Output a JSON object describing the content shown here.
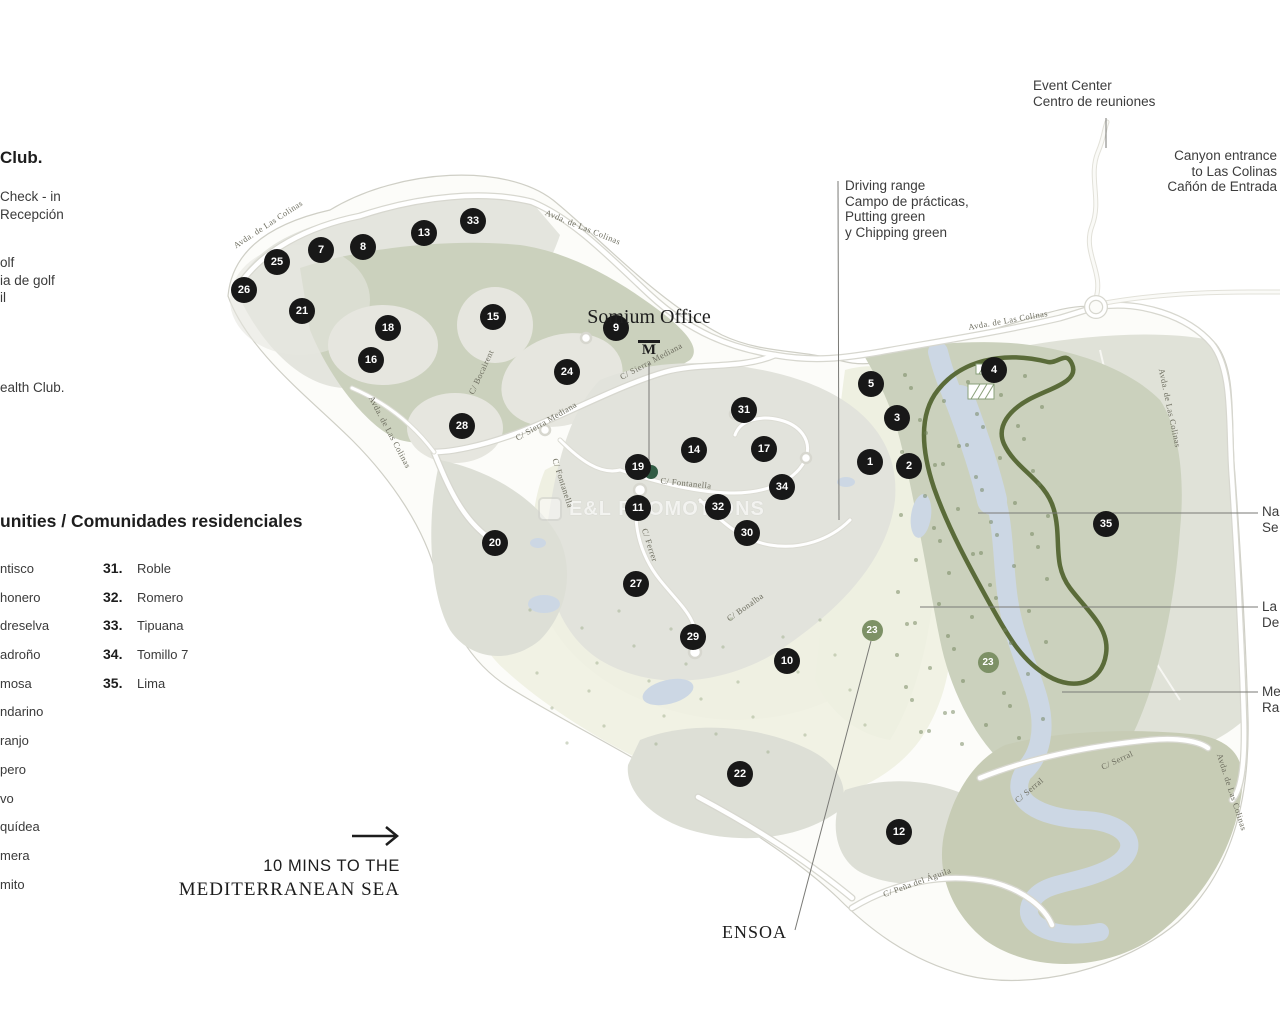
{
  "left_panel": {
    "club_fragment": "Club.",
    "checkin_lines": [
      "Check - in",
      "Recepción"
    ],
    "golf_fragments": [
      "olf",
      "ia de golf",
      "il"
    ],
    "health_fragment": "ealth Club.",
    "communities_heading": "unities / Comunidades residenciales",
    "communities_left": [
      "ntisco",
      "honero",
      "dreselva",
      "adroño",
      "mosa",
      "ndarino",
      "ranjo",
      "pero",
      "vo",
      "quídea",
      "mera",
      "mito"
    ],
    "communities_right": [
      {
        "num": "31.",
        "name": "Roble"
      },
      {
        "num": "32.",
        "name": "Romero"
      },
      {
        "num": "33.",
        "name": "Tipuana"
      },
      {
        "num": "34.",
        "name": "Tomillo 7"
      },
      {
        "num": "35.",
        "name": "Lima"
      }
    ],
    "sea_note_line1": "10 MINS TO THE",
    "sea_note_line2": "MEDITERRANEAN SEA"
  },
  "annotations": {
    "somium_label": "Somium Office",
    "somium_logo": "M",
    "driving_range_lines": [
      "Driving range",
      "Campo de prácticas,",
      "Putting green",
      "y Chipping green"
    ],
    "event_center_lines": [
      "Event Center",
      "Centro de reuniones"
    ],
    "canyon_entrance_lines": [
      "Canyon entrance",
      "to Las Colinas",
      "Cañón de Entrada"
    ],
    "right_edge_labels": [
      {
        "lines": [
          "Na",
          "Se"
        ],
        "top": 504
      },
      {
        "lines": [
          "La",
          "De"
        ],
        "top": 599
      },
      {
        "lines": [
          "Me",
          "Ra"
        ],
        "top": 684
      }
    ],
    "ensoa": "ENSOA",
    "watermark": "E&L PROMOTIONS"
  },
  "map": {
    "colors": {
      "marker_black": "#181818",
      "marker_green": "#7d9166",
      "office_dot": "#315c44",
      "trail": "#5a6b39",
      "water": "#ccd7e4",
      "sage": "#cbd1bd",
      "parcel": "#e3e4dd",
      "fairway": "#f1f2e4"
    },
    "street_labels": [
      {
        "text": "Avda. de Las Colinas",
        "x": 268,
        "y": 224,
        "rot": -33
      },
      {
        "text": "Avda. de Las Colinas",
        "x": 583,
        "y": 227,
        "rot": 22
      },
      {
        "text": "Avda. de Las Colinas",
        "x": 390,
        "y": 432,
        "rot": 62
      },
      {
        "text": "Avda. de Las Colinas",
        "x": 1008,
        "y": 320,
        "rot": -10
      },
      {
        "text": "Avda. de Las Colinas",
        "x": 1170,
        "y": 408,
        "rot": 78
      },
      {
        "text": "Avda. de Las Colinas",
        "x": 1232,
        "y": 792,
        "rot": 72
      },
      {
        "text": "C/ Sierra Mediana",
        "x": 546,
        "y": 421,
        "rot": -30
      },
      {
        "text": "C/ Sierra Mediana",
        "x": 651,
        "y": 361,
        "rot": -28
      },
      {
        "text": "C/ Fontanella",
        "x": 686,
        "y": 483,
        "rot": 6
      },
      {
        "text": "C/ Fontanella",
        "x": 563,
        "y": 483,
        "rot": 72
      },
      {
        "text": "C/ Ferrer",
        "x": 650,
        "y": 545,
        "rot": 72
      },
      {
        "text": "C/ Bocairent",
        "x": 481,
        "y": 372,
        "rot": -65
      },
      {
        "text": "C/ Bonalba",
        "x": 745,
        "y": 607,
        "rot": -35
      },
      {
        "text": "C/ Serral",
        "x": 1029,
        "y": 790,
        "rot": -40
      },
      {
        "text": "C/ Serral",
        "x": 1117,
        "y": 760,
        "rot": -25
      },
      {
        "text": "C/ Peña del Águila",
        "x": 917,
        "y": 882,
        "rot": -20
      }
    ],
    "markers": [
      {
        "n": "1",
        "x": 870,
        "y": 462,
        "type": "black"
      },
      {
        "n": "2",
        "x": 909,
        "y": 466,
        "type": "black"
      },
      {
        "n": "3",
        "x": 897,
        "y": 418,
        "type": "black"
      },
      {
        "n": "4",
        "x": 994,
        "y": 370,
        "type": "black"
      },
      {
        "n": "5",
        "x": 871,
        "y": 384,
        "type": "black"
      },
      {
        "n": "7",
        "x": 321,
        "y": 250,
        "type": "black"
      },
      {
        "n": "8",
        "x": 363,
        "y": 247,
        "type": "black"
      },
      {
        "n": "9",
        "x": 616,
        "y": 328,
        "type": "black"
      },
      {
        "n": "10",
        "x": 787,
        "y": 661,
        "type": "black"
      },
      {
        "n": "11",
        "x": 638,
        "y": 508,
        "type": "black"
      },
      {
        "n": "12",
        "x": 899,
        "y": 832,
        "type": "black"
      },
      {
        "n": "13",
        "x": 424,
        "y": 233,
        "type": "black"
      },
      {
        "n": "14",
        "x": 694,
        "y": 450,
        "type": "black"
      },
      {
        "n": "15",
        "x": 493,
        "y": 317,
        "type": "black"
      },
      {
        "n": "16",
        "x": 371,
        "y": 360,
        "type": "black"
      },
      {
        "n": "17",
        "x": 764,
        "y": 449,
        "type": "black"
      },
      {
        "n": "18",
        "x": 388,
        "y": 328,
        "type": "black"
      },
      {
        "n": "19",
        "x": 638,
        "y": 467,
        "type": "black"
      },
      {
        "n": "20",
        "x": 495,
        "y": 543,
        "type": "black"
      },
      {
        "n": "21",
        "x": 302,
        "y": 311,
        "type": "black"
      },
      {
        "n": "22",
        "x": 740,
        "y": 774,
        "type": "black"
      },
      {
        "n": "23",
        "x": 872,
        "y": 630,
        "type": "green"
      },
      {
        "n": "23",
        "x": 988,
        "y": 662,
        "type": "green"
      },
      {
        "n": "24",
        "x": 567,
        "y": 372,
        "type": "black"
      },
      {
        "n": "25",
        "x": 277,
        "y": 262,
        "type": "black"
      },
      {
        "n": "26",
        "x": 244,
        "y": 290,
        "type": "black"
      },
      {
        "n": "27",
        "x": 636,
        "y": 584,
        "type": "black"
      },
      {
        "n": "28",
        "x": 462,
        "y": 426,
        "type": "black"
      },
      {
        "n": "29",
        "x": 693,
        "y": 637,
        "type": "black"
      },
      {
        "n": "30",
        "x": 747,
        "y": 533,
        "type": "black"
      },
      {
        "n": "31",
        "x": 744,
        "y": 410,
        "type": "black"
      },
      {
        "n": "32",
        "x": 718,
        "y": 507,
        "type": "black"
      },
      {
        "n": "33",
        "x": 473,
        "y": 221,
        "type": "black"
      },
      {
        "n": "34",
        "x": 782,
        "y": 487,
        "type": "black"
      },
      {
        "n": "35",
        "x": 1106,
        "y": 524,
        "type": "black"
      }
    ]
  }
}
